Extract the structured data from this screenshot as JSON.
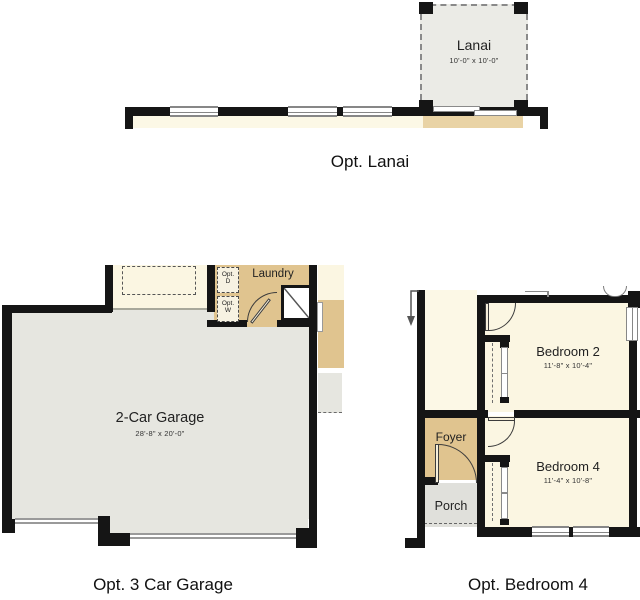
{
  "page": {
    "background": "#ffffff"
  },
  "colors": {
    "wall": "#151515",
    "living_cream": "#fbf6e2",
    "accent_tan": "#e0c48f",
    "lanai_patio_tan": "#e9d3a5",
    "garage_gray": "#e6e6e0",
    "porch_gray": "#e0e0db",
    "lanai_fill": "#ebebe6",
    "window_frame": "#878787"
  },
  "sections": {
    "lanai": {
      "title": "Opt. Lanai",
      "room": {
        "name": "Lanai",
        "dims": "10'-0\" x 10'-0\""
      }
    },
    "garage": {
      "title": "Opt. 3 Car Garage",
      "room": {
        "name": "2-Car Garage",
        "dims": "28'-8\" x 20'-0\""
      },
      "laundry_label": "Laundry",
      "opt_dryer": {
        "line1": "Opt.",
        "line2": "D"
      },
      "opt_washer": {
        "line1": "Opt.",
        "line2": "W"
      }
    },
    "bedroom4": {
      "title": "Opt. Bedroom 4",
      "bedroom2": {
        "name": "Bedroom 2",
        "dims": "11'-8\" x 10'-4\""
      },
      "bedroom4": {
        "name": "Bedroom 4",
        "dims": "11'-4\" x 10'-8\""
      },
      "foyer_label": "Foyer",
      "porch_label": "Porch"
    }
  }
}
